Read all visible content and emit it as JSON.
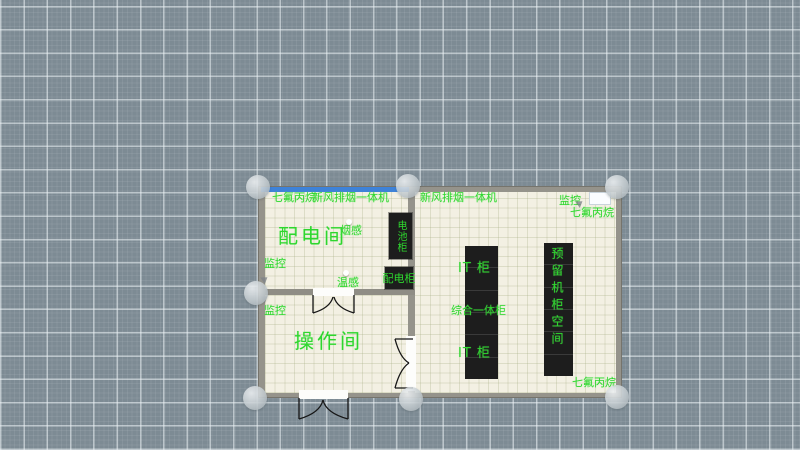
{
  "floor_plan": {
    "rooms": {
      "power_room": "配电间",
      "operation_room": "操作间"
    },
    "suppression_agent_labels": {
      "top_left": "七氟丙烷",
      "top_right": "七氟丙烷",
      "bottom_right": "七氟丙烷"
    },
    "fresh_air_units": {
      "left": "新风排烟一体机",
      "right": "新风排烟一体机"
    },
    "monitors": {
      "top_right": "监控",
      "power_room": "监控",
      "operation_room": "监控"
    },
    "sensors": {
      "smoke": "烟感",
      "temperature": "温感"
    },
    "equipment": {
      "battery_cabinet": "电池柜",
      "power_cabinet": "配电柜"
    },
    "racks": {
      "row_a": {
        "top_label": "IT 柜",
        "middle_label": "综合一体柜",
        "bottom_label": "IT 柜",
        "segments": 6
      },
      "row_b": {
        "label": "预留机柜空间",
        "segments": 6
      }
    },
    "colors": {
      "annotation_green": "#2ed62e",
      "selection_blue": "#3e82d8",
      "wall_gray": "#95938b",
      "floor_cream": "#f3f0e3",
      "rack_black": "#1d1d1d",
      "canvas_blue_gray": "#7d8b94"
    }
  }
}
